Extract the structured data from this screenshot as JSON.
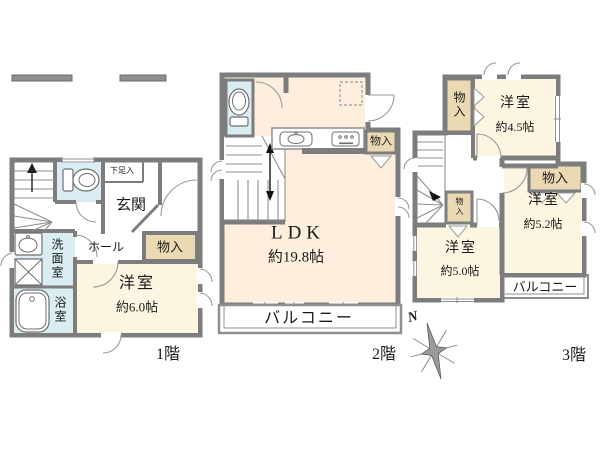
{
  "floor1": {
    "floor_label": "1階",
    "genkan": "玄関",
    "shoe_storage": "下足入",
    "hall": "ホール",
    "storage": "物入",
    "washroom": "洗面室",
    "bathroom": "浴室",
    "bedroom_name": "洋室",
    "bedroom_size": "約6.0帖"
  },
  "floor2": {
    "floor_label": "2階",
    "ldk_name": "LDK",
    "ldk_size": "約19.8帖",
    "storage": "物入",
    "balcony": "バルコニー"
  },
  "floor3": {
    "floor_label": "3階",
    "bedroom45_name": "洋室",
    "bedroom45_size": "約4.5帖",
    "bedroom52_name": "洋室",
    "bedroom52_size": "約5.2帖",
    "bedroom50_name": "洋室",
    "bedroom50_size": "約5.0帖",
    "storage_top": "物入",
    "storage_small": "物入",
    "storage_mid": "物入",
    "balcony": "バルコニー"
  },
  "compass": {
    "north": "N"
  },
  "icons": {
    "toilet": "tank-and-bowl shape",
    "bathtub": "rounded rectangle tub",
    "sink": "oval basin in box",
    "washing_machine": "square with X",
    "kitchen_sink": "counter with oval sink",
    "stove": "counter with burner dots",
    "stairs": "tread lines with arrow",
    "compass": "eight-point star"
  },
  "colors": {
    "wall": "#7d7d7d",
    "wall_light": "#8f8f8f",
    "room_cream": "#fbf5e1",
    "room_peach": "#fdeedd",
    "wet_blue": "#d9edf2",
    "storage_tan": "#ead9b3",
    "text": "#1a1a1a"
  }
}
